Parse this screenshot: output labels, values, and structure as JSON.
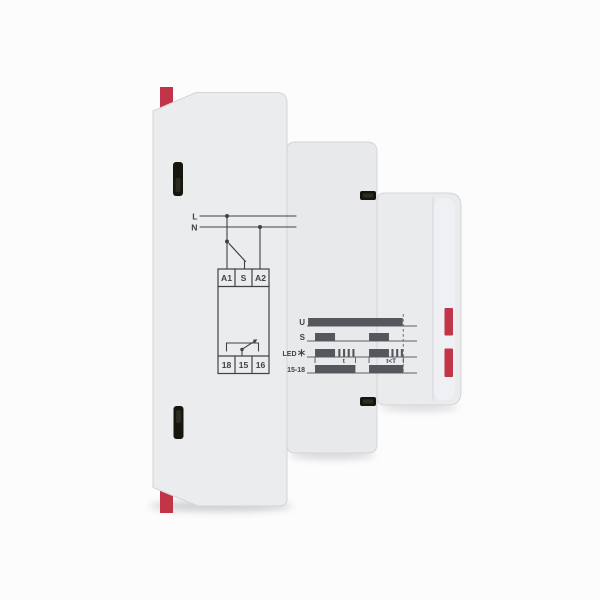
{
  "product": {
    "description": "Side profile of a grey DIN-rail timing relay module with red mounting clips, terminal slots, and printed wiring and timing diagrams",
    "body_color": "#ebecee",
    "body_mid_color": "#e8e9eb",
    "body_front_color": "#eaebed",
    "accent_red": "#c23448",
    "ink_color": "#3f4247",
    "bar_color": "#54575c",
    "slot_color": "#16160e"
  },
  "wiring_diagram": {
    "supply_lines": {
      "line1": "L",
      "line2": "N"
    },
    "top_terminals": [
      "A1",
      "S",
      "A2"
    ],
    "bottom_terminals": [
      "18",
      "15",
      "16"
    ]
  },
  "chart_data": {
    "type": "timing",
    "timeline": [
      0,
      100
    ],
    "rows": [
      {
        "label": "U",
        "segments": [
          {
            "t0": 1,
            "t1": 87,
            "state": "on"
          }
        ]
      },
      {
        "label": "S",
        "segments": [
          {
            "t0": 7.3,
            "t1": 25.5,
            "state": "on"
          },
          {
            "t0": 56.4,
            "t1": 74.5,
            "state": "on"
          }
        ]
      },
      {
        "label": "LED",
        "icon": "blink-asterisk",
        "segments": [
          {
            "t0": 7.3,
            "t1": 25.5,
            "state": "on"
          },
          {
            "t0": 28,
            "t1": 44.5,
            "state": "blink"
          },
          {
            "t0": 56.4,
            "t1": 74.5,
            "state": "on"
          },
          {
            "t0": 76.3,
            "t1": 88,
            "state": "blink"
          }
        ]
      },
      {
        "label": "15-18",
        "segments": [
          {
            "t0": 7.3,
            "t1": 44,
            "state": "on"
          },
          {
            "t0": 56.4,
            "t1": 87.5,
            "state": "on"
          }
        ]
      }
    ],
    "annotations": [
      {
        "label": "t",
        "from": 7.3,
        "to": 44,
        "at": 33.5
      },
      {
        "label": "t<T",
        "from": 56.4,
        "to": 87.5,
        "at": 76.5
      }
    ],
    "supply_off_marker_t": 87.5
  },
  "icons": {
    "led_blink_icon": "asterisk-flash",
    "din_clip_top": "red-clip-tab",
    "din_clip_bottom": "red-clip-tab",
    "front_red_markers": "red-bars"
  }
}
